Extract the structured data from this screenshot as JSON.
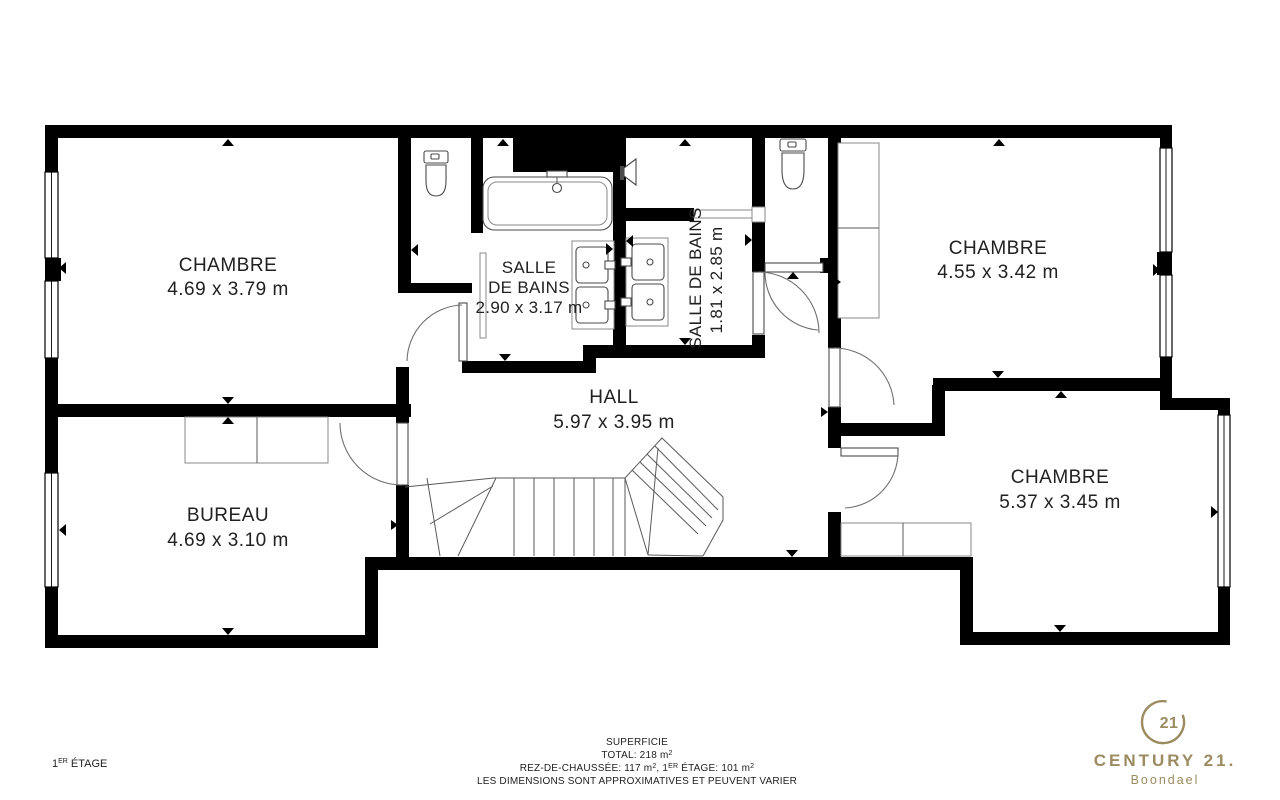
{
  "page": {
    "background": "#ffffff"
  },
  "plan": {
    "wall_color": "#000000",
    "label_color": "#212121",
    "rooms": [
      {
        "id": "chambre-top-left",
        "name": "CHAMBRE",
        "dims": "4.69 x 3.79 m"
      },
      {
        "id": "salle-de-bains-1",
        "name_line1": "SALLE",
        "name_line2": "DE BAINS",
        "dims": "2.90 x 3.17 m"
      },
      {
        "id": "salle-de-bains-2",
        "name": "SALLE DE BAINS",
        "dims": "1.81 x 2.85 m"
      },
      {
        "id": "chambre-top-right",
        "name": "CHAMBRE",
        "dims": "4.55 x 3.42 m"
      },
      {
        "id": "hall",
        "name": "HALL",
        "dims": "5.97 x 3.95 m"
      },
      {
        "id": "bureau",
        "name": "BUREAU",
        "dims": "4.69 x 3.10 m"
      },
      {
        "id": "chambre-bottom-right",
        "name": "CHAMBRE",
        "dims": "5.37 x 3.45 m"
      }
    ]
  },
  "floor_label": {
    "num": "1",
    "sup": "ER",
    "rest": " ÉTAGE"
  },
  "footer": {
    "title": "SUPERFICIE",
    "total": {
      "text": "TOTAL: 218 m",
      "sup": "2"
    },
    "line3": {
      "p1": "REZ-DE-CHAUSSÉE: 117 m",
      "s1": "2",
      "p2": ", 1",
      "s2": "ER",
      "p3": " ÉTAGE: 101 m",
      "s3": "2"
    },
    "disclaimer": "LES DIMENSIONS SONT APPROXIMATIVES ET PEUVENT VARIER"
  },
  "brand": {
    "seal_number": "21",
    "name": "CENTURY 21.",
    "agency": "Boondael",
    "color": "#9c8b60"
  }
}
